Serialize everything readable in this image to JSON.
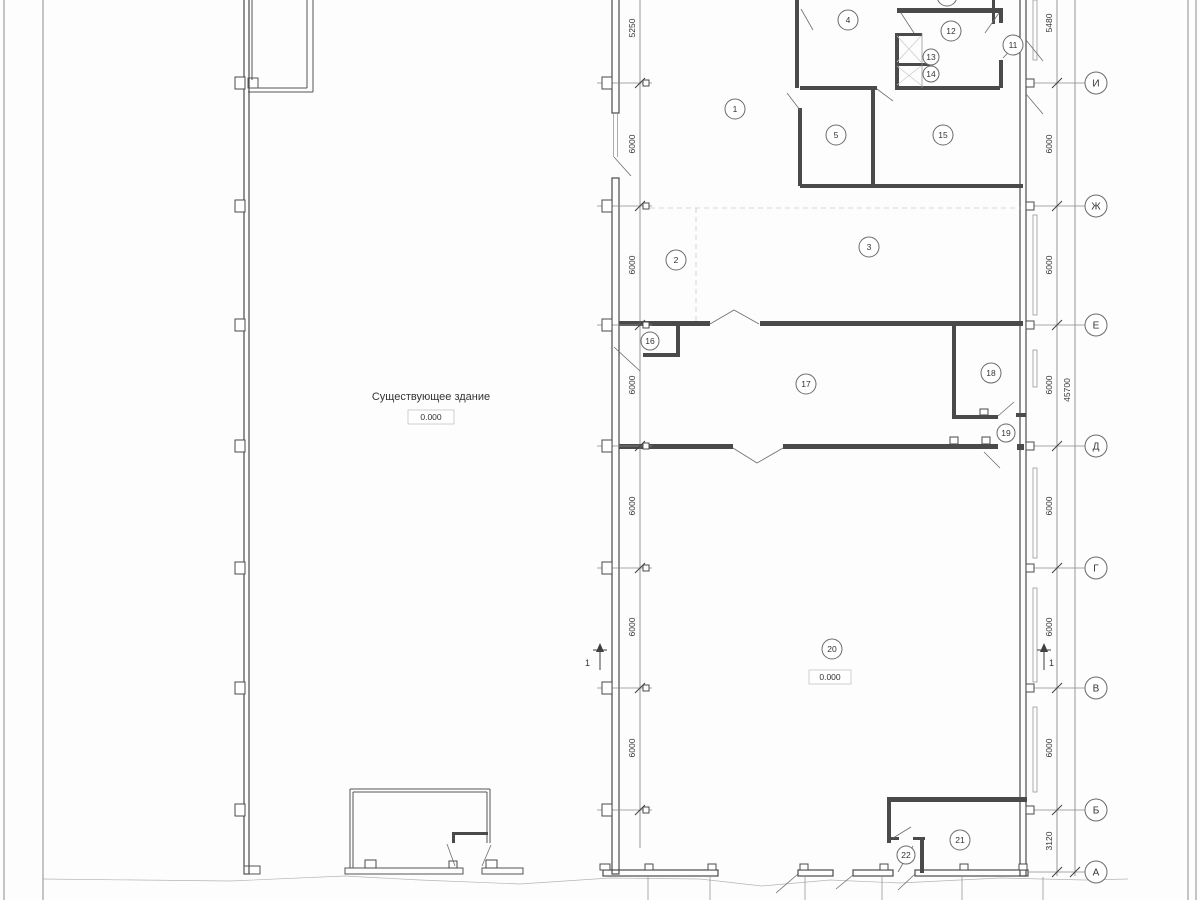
{
  "drawing": {
    "existing_building_label": "Существующее здание",
    "existing_building_elevation": "0.000",
    "new_building_elevation": "0.000",
    "section_marker_left": "1",
    "section_marker_right": "1"
  },
  "rooms": [
    {
      "number": "1",
      "x": 735,
      "y": 109
    },
    {
      "number": "2",
      "x": 676,
      "y": 260
    },
    {
      "number": "3",
      "x": 869,
      "y": 247
    },
    {
      "number": "4",
      "x": 848,
      "y": 20
    },
    {
      "number": "5",
      "x": 836,
      "y": 135
    },
    {
      "number": "11",
      "x": 1013,
      "y": 45
    },
    {
      "number": "12",
      "x": 951,
      "y": 31
    },
    {
      "number": "13",
      "x": 931,
      "y": 57,
      "r": 8
    },
    {
      "number": "14",
      "x": 931,
      "y": 74,
      "r": 8
    },
    {
      "number": "15",
      "x": 943,
      "y": 135
    },
    {
      "number": "16",
      "x": 650,
      "y": 341,
      "r": 9
    },
    {
      "number": "17",
      "x": 806,
      "y": 384
    },
    {
      "number": "18",
      "x": 991,
      "y": 373
    },
    {
      "number": "19",
      "x": 1006,
      "y": 433,
      "r": 9
    },
    {
      "number": "20",
      "x": 832,
      "y": 649
    },
    {
      "number": "21",
      "x": 960,
      "y": 840
    },
    {
      "number": "22",
      "x": 906,
      "y": 855,
      "r": 9
    },
    {
      "number": "",
      "x": 947,
      "y": -4
    }
  ],
  "axes": {
    "cx": 1096,
    "r": 11,
    "rows": [
      {
        "label": "И",
        "y": 83
      },
      {
        "label": "Ж",
        "y": 206
      },
      {
        "label": "Е",
        "y": 325
      },
      {
        "label": "Д",
        "y": 446
      },
      {
        "label": "Г",
        "y": 568
      },
      {
        "label": "В",
        "y": 688
      },
      {
        "label": "Б",
        "y": 810
      },
      {
        "label": "А",
        "y": 872
      }
    ]
  },
  "dimensions": {
    "left_line": {
      "x": 640,
      "labels": [
        {
          "text": "5250",
          "y": 28
        },
        {
          "text": "6000",
          "y": 144
        },
        {
          "text": "6000",
          "y": 265
        },
        {
          "text": "6000",
          "y": 385
        },
        {
          "text": "6000",
          "y": 506
        },
        {
          "text": "6000",
          "y": 627
        },
        {
          "text": "6000",
          "y": 748
        }
      ]
    },
    "right_line": {
      "x": 1057,
      "labels": [
        {
          "text": "5480",
          "y": 23
        },
        {
          "text": "6000",
          "y": 144
        },
        {
          "text": "6000",
          "y": 265
        },
        {
          "text": "6000",
          "y": 385
        },
        {
          "text": "6000",
          "y": 506
        },
        {
          "text": "6000",
          "y": 627
        },
        {
          "text": "6000",
          "y": 748
        },
        {
          "text": "3120",
          "y": 841
        }
      ]
    },
    "total": {
      "text": "45700",
      "x": 1075,
      "y": 390
    }
  },
  "colors": {
    "wall": "#4a4a4a",
    "line": "#555555",
    "dashed": "#c9c9c9",
    "text": "#333333"
  }
}
